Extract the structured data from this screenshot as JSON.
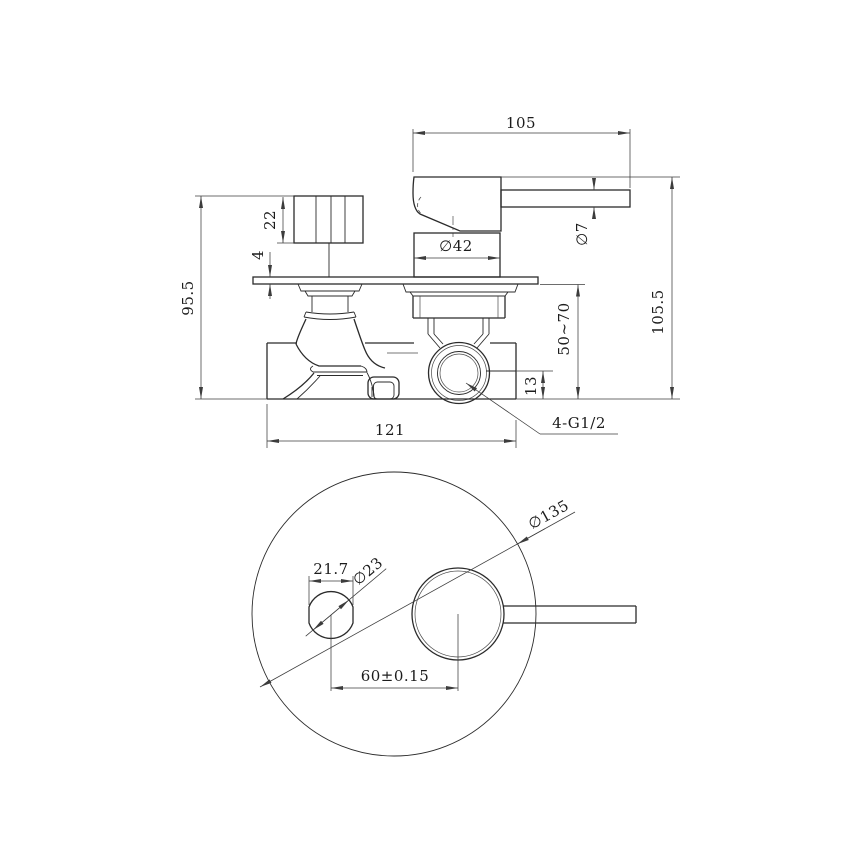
{
  "drawing": {
    "type": "technical-dimension-drawing",
    "subject": "concealed shower mixer valve",
    "colors": {
      "line": "#2b2b2b",
      "dimension_line": "#3c3c3c",
      "text": "#1c1c1c",
      "background": "#ffffff"
    },
    "front_view": {
      "handle_length": "105",
      "lever_diameter": "∅7",
      "knob_height": "22",
      "plate_thickness": "4",
      "overall_height_left": "95.5",
      "cartridge_diameter": "∅42",
      "installation_depth_range": "50~70",
      "overall_height_right": "105.5",
      "outlet_offset": "13",
      "body_width": "121",
      "thread_spec": "4-G1/2"
    },
    "bottom_view": {
      "plate_diameter": "∅135",
      "knob_flat_width": "21.7",
      "knob_diameter": "∅23",
      "center_distance": "60±0.15"
    }
  }
}
